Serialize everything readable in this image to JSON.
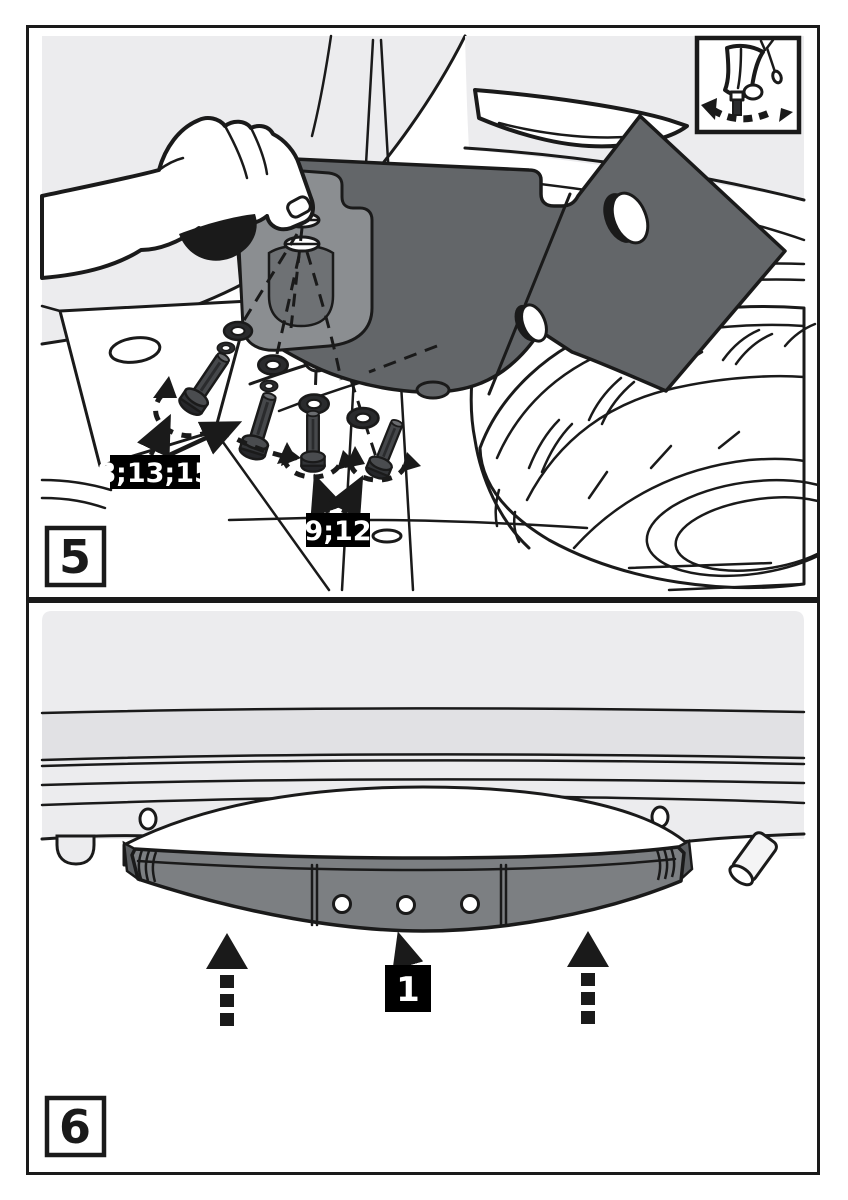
{
  "document": {
    "kind": "towbar-installation-instruction-page"
  },
  "colors": {
    "outline": "#1a1a1a",
    "body_gray": "#ececee",
    "band_gray": "#e1e1e4",
    "bracket_gray": "#636669",
    "clamp_gray": "#8b8e91",
    "clamp_inner_gray": "#6e7174",
    "beam_gray": "#7c7f82",
    "hardware_dark": "#2e2f31",
    "label_bg": "#000000",
    "label_fg": "#ffffff"
  },
  "step5": {
    "step_label": "5",
    "callout_side_bolts": "8;13;15",
    "callout_bottom_bolts": "9;12",
    "inset_icon": "hand-tighten-bolt-icon"
  },
  "step6": {
    "step_label": "6",
    "callout_crossbar": "1"
  }
}
